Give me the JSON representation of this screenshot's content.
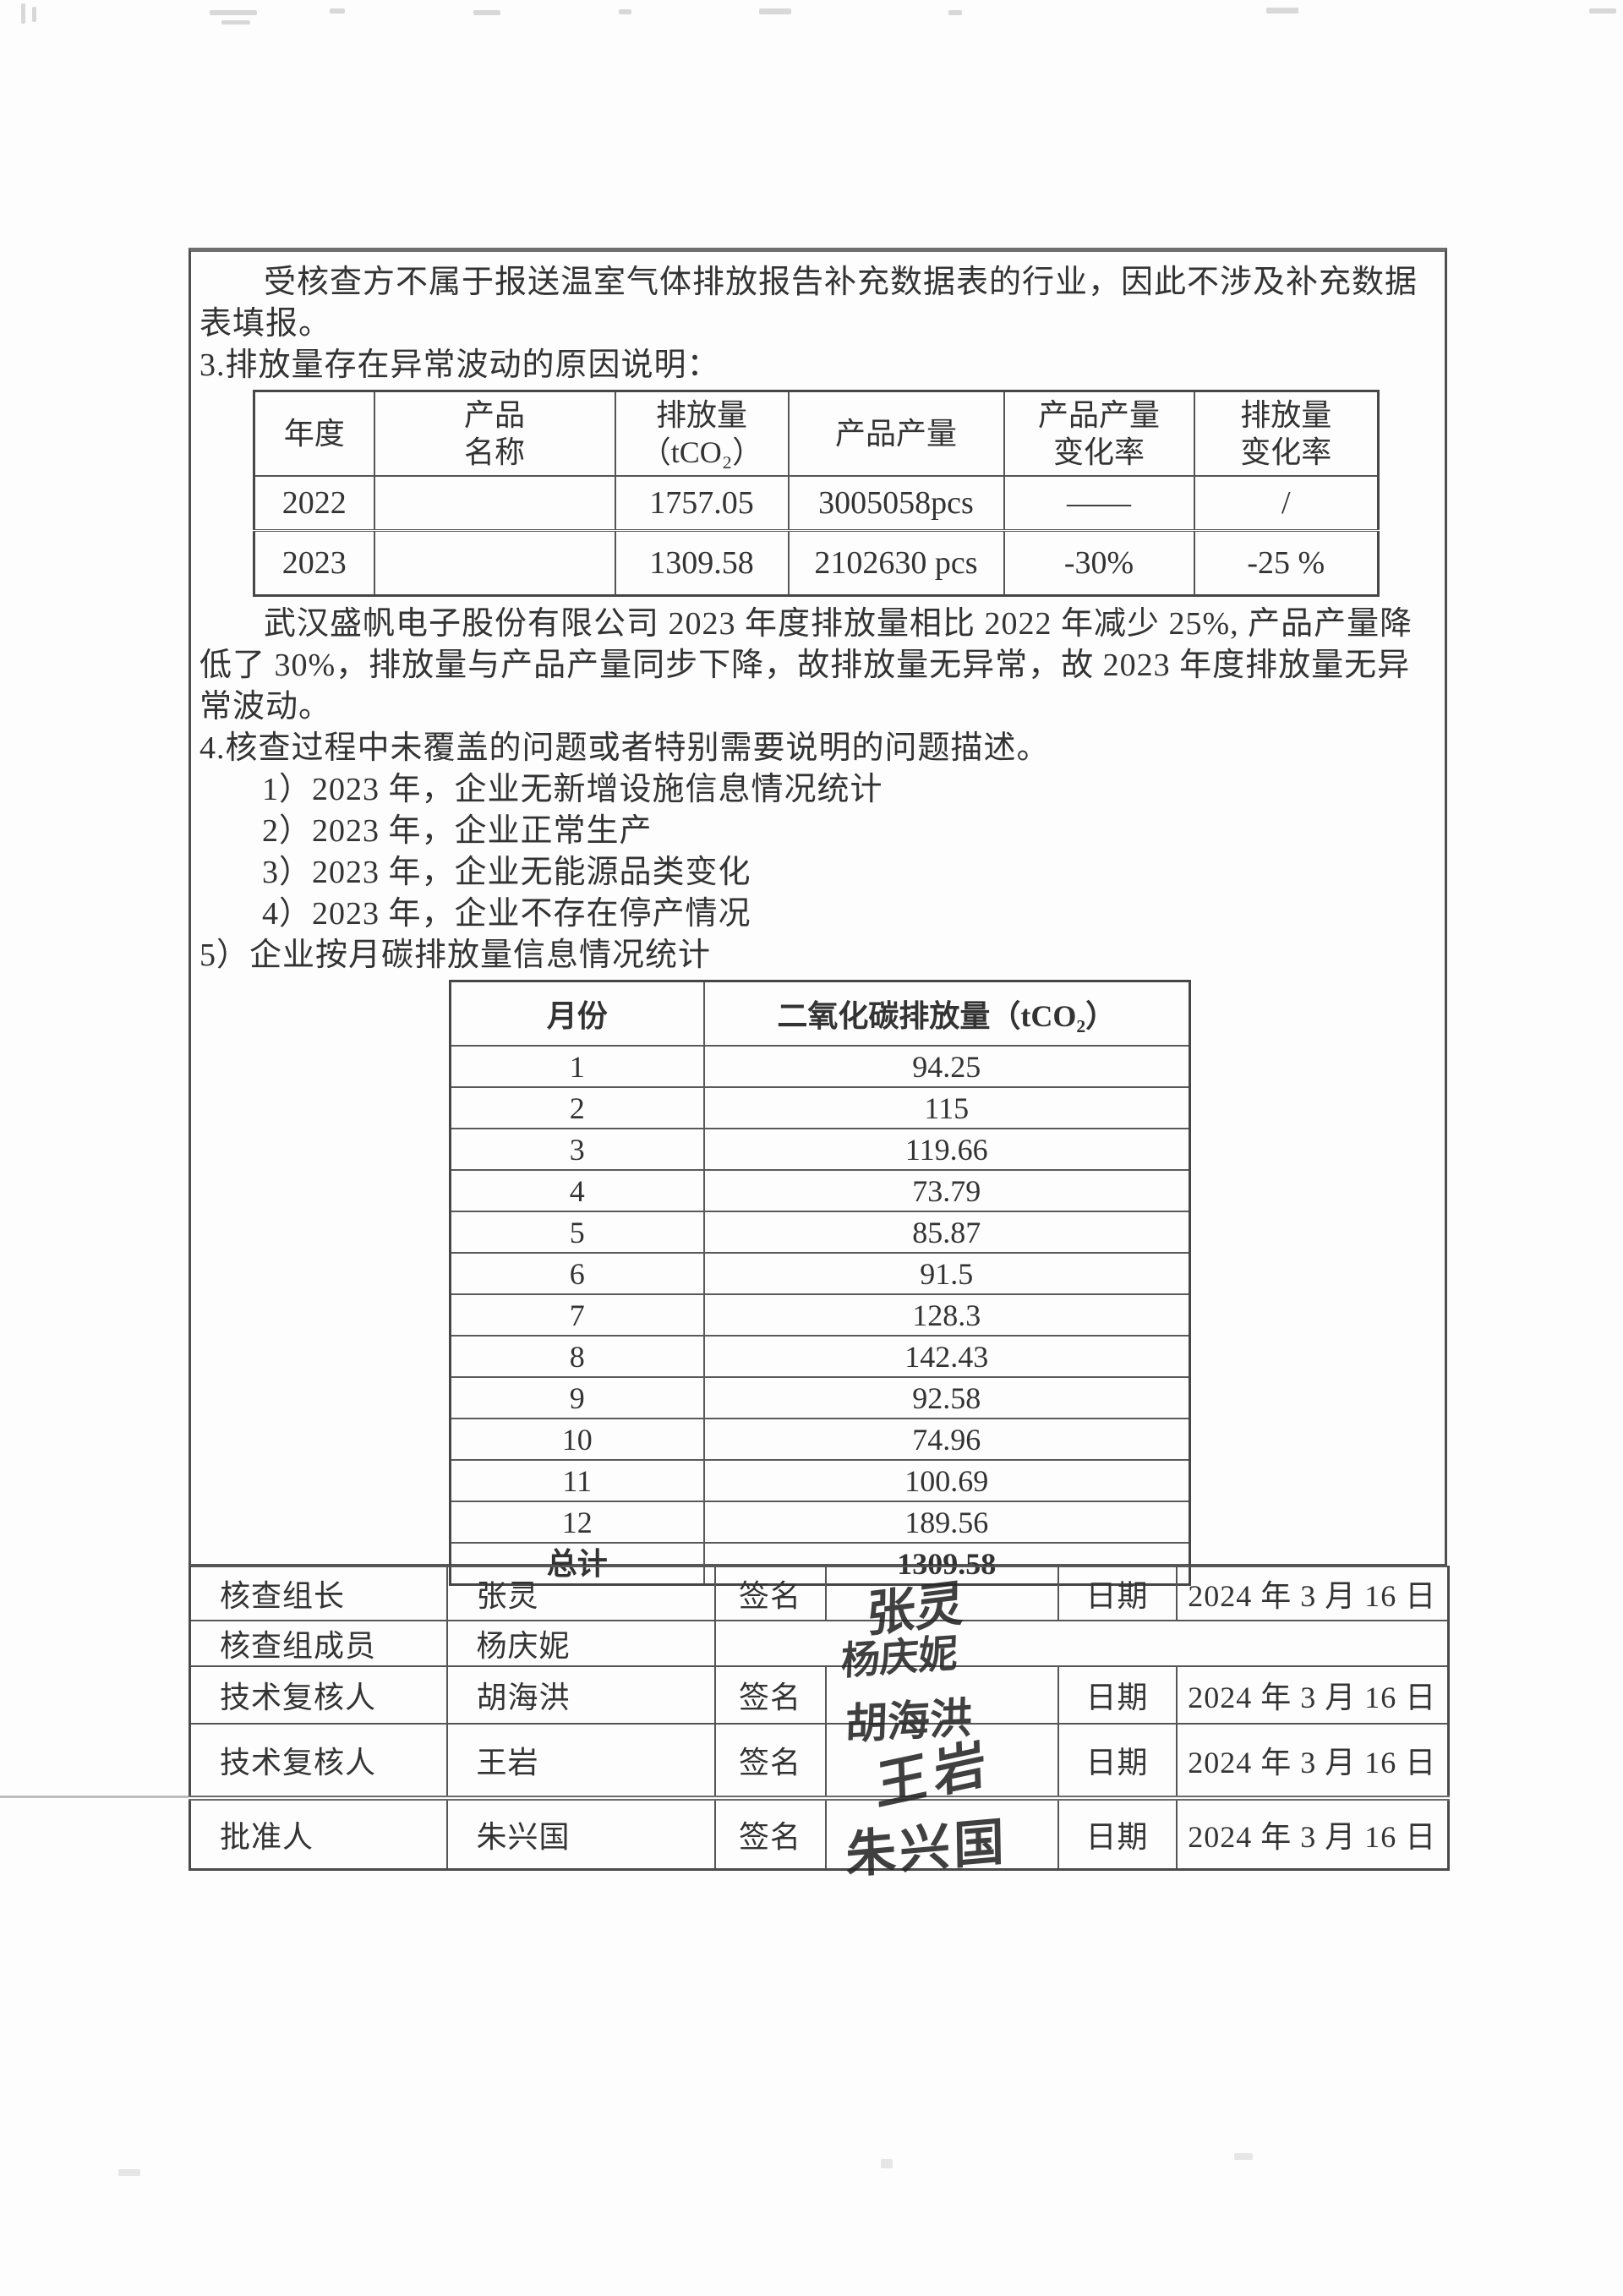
{
  "intro": {
    "paragraph": "受核查方不属于报送温室气体排放报告补充数据表的行业，因此不涉及补充数据表填报。"
  },
  "section3": {
    "heading": "3.排放量存在异常波动的原因说明："
  },
  "comparison_table": {
    "headers": [
      [
        "年度"
      ],
      [
        "产品",
        "名称"
      ],
      [
        "排放量",
        "（tCO₂）"
      ],
      [
        "产品产量"
      ],
      [
        "产品产量",
        "变化率"
      ],
      [
        "排放量",
        "变化率"
      ]
    ],
    "rows": [
      [
        "2022",
        "",
        "1757.05",
        "3005058pcs",
        "——",
        "/"
      ],
      [
        "2023",
        "",
        "1309.58",
        "2102630 pcs",
        "-30%",
        "-25 %"
      ]
    ]
  },
  "analysis": {
    "paragraph": "武汉盛帆电子股份有限公司 2023 年度排放量相比 2022 年减少 25%, 产品产量降低了 30%，排放量与产品产量同步下降，故排放量无异常，故 2023 年度排放量无异常波动。"
  },
  "section4": {
    "heading": "4.核查过程中未覆盖的问题或者特别需要说明的问题描述。",
    "items": [
      "1）2023 年，企业无新增设施信息情况统计",
      "2）2023 年，企业正常生产",
      "3）2023 年，企业无能源品类变化",
      "4）2023 年，企业不存在停产情况"
    ],
    "item5": "5）企业按月碳排放量信息情况统计"
  },
  "monthly_table": {
    "headers": [
      "月份",
      "二氧化碳排放量（tCO₂）"
    ],
    "rows": [
      [
        "1",
        "94.25"
      ],
      [
        "2",
        "115"
      ],
      [
        "3",
        "119.66"
      ],
      [
        "4",
        "73.79"
      ],
      [
        "5",
        "85.87"
      ],
      [
        "6",
        "91.5"
      ],
      [
        "7",
        "128.3"
      ],
      [
        "8",
        "142.43"
      ],
      [
        "9",
        "92.58"
      ],
      [
        "10",
        "74.96"
      ],
      [
        "11",
        "100.69"
      ],
      [
        "12",
        "189.56"
      ],
      [
        "总计",
        "1309.58"
      ]
    ]
  },
  "signoff": {
    "sign_label": "签名",
    "date_label": "日期",
    "rows": [
      {
        "role": "核查组长",
        "name": "张灵",
        "signature": "张灵",
        "date": "2024 年 3 月 16 日"
      },
      {
        "role": "核查组成员",
        "name": "杨庆妮",
        "signature": "杨庆妮",
        "date": ""
      },
      {
        "role": "技术复核人",
        "name": "胡海洪",
        "signature": "胡海洪",
        "date": "2024 年 3 月 16 日"
      },
      {
        "role": "技术复核人",
        "name": "王岩",
        "signature": "王岩",
        "date": "2024 年 3 月 16 日"
      },
      {
        "role": "批准人",
        "name": "朱兴国",
        "signature": "朱兴国",
        "date": "2024 年 3 月 16 日"
      }
    ]
  },
  "colors": {
    "ink": "#333333",
    "border": "#4f4f4f",
    "paper": "#fdfdfd"
  }
}
